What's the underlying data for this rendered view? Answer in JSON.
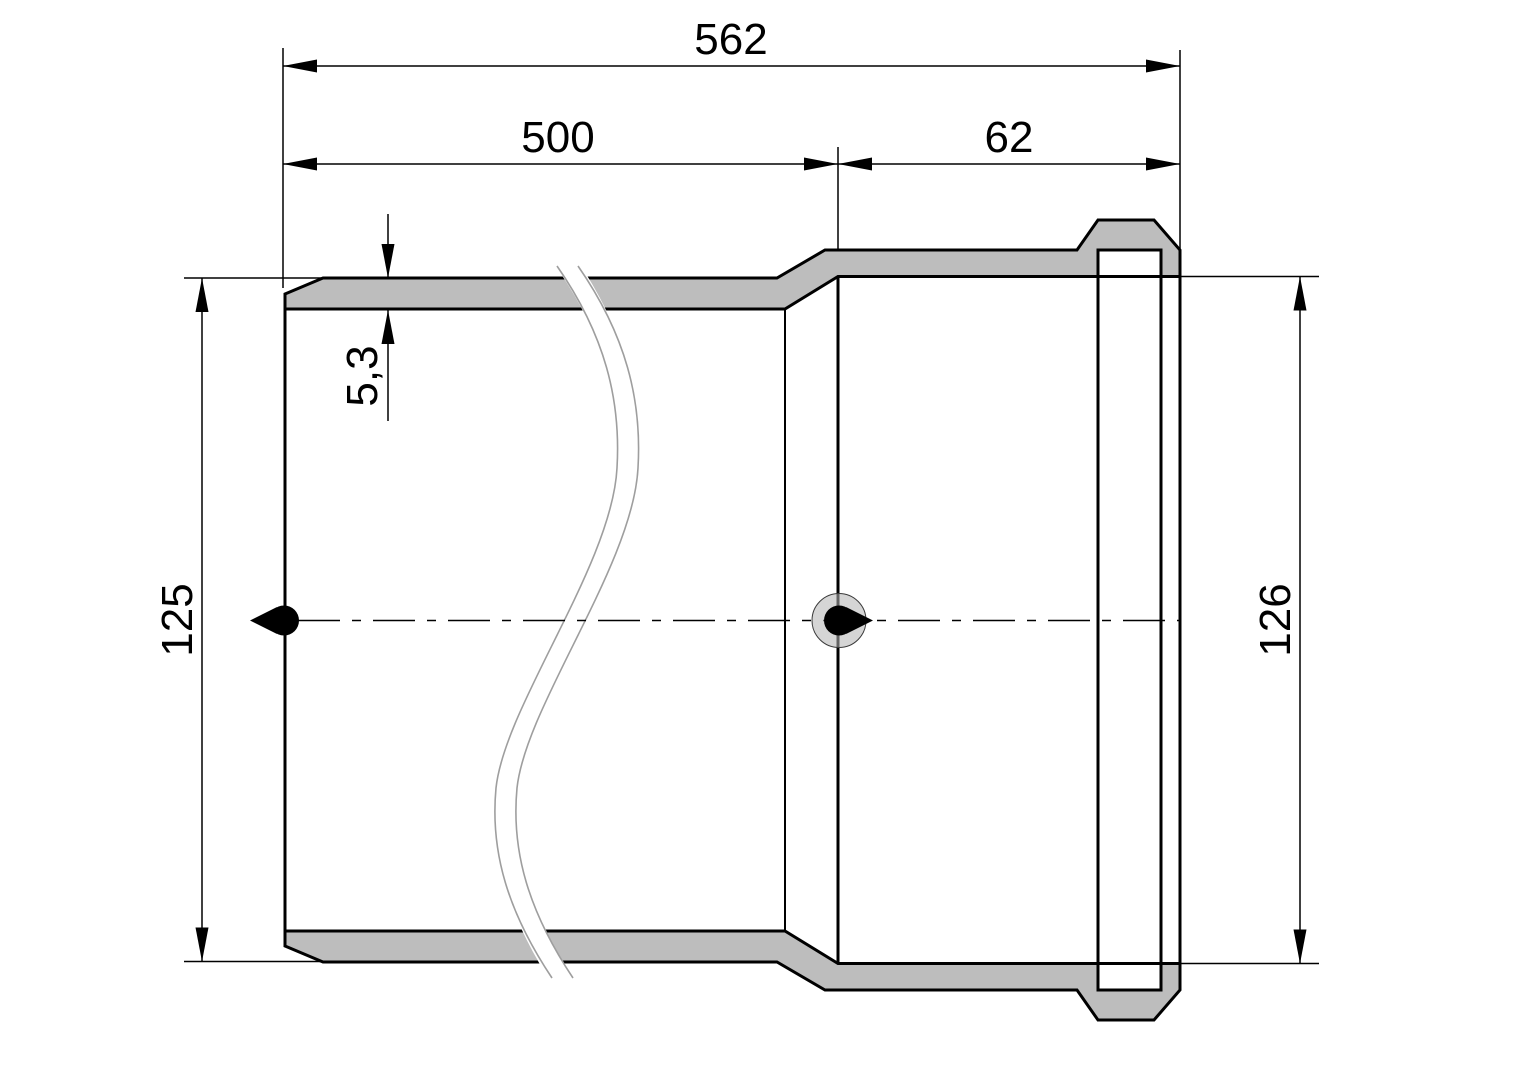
{
  "drawing": {
    "dimensions": {
      "overall_length": "562",
      "pipe_length": "500",
      "socket_length": "62",
      "wall_thickness": "5,3",
      "outer_diameter": "125",
      "socket_inner_diameter": "126"
    },
    "colors": {
      "background": "#ffffff",
      "wall_fill": "#bdbdbd",
      "outline": "#000000",
      "break_line": "#9e9e9e",
      "marker_halo": "#b3b3b3",
      "marker_dot": "#000000"
    }
  }
}
